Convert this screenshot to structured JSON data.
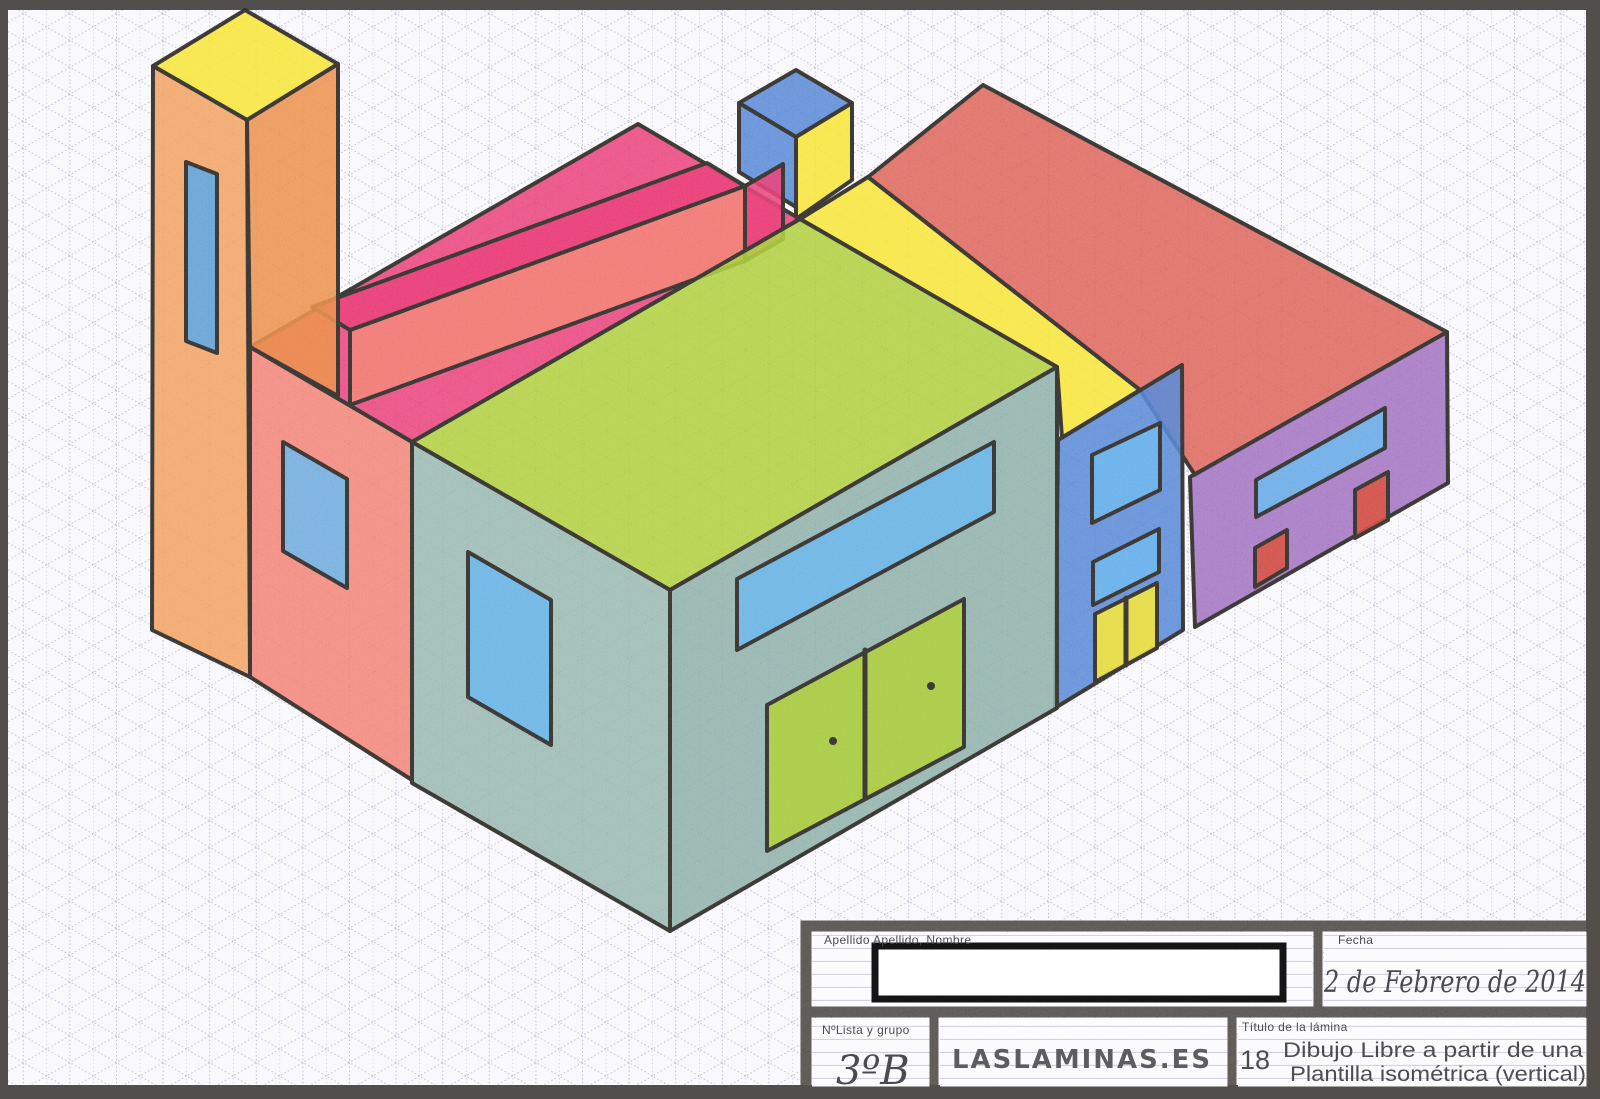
{
  "colors": {
    "frame": "#524e4c",
    "paper": "#f8f7fb",
    "grid": "#a8a4c2",
    "outline": "#2f2c29",
    "orange": "#f09a55",
    "orange_dark": "#e98840",
    "yellow": "#f6e42a",
    "window_blue": "#4f9fe3",
    "sky_blue": "#62b0ea",
    "magenta": "#e7366f",
    "salmon": "#f17a6c",
    "green": "#a7cb30",
    "teal_left": "#90b2a9",
    "teal_right": "#84aaa2",
    "blue": "#4b7fd3",
    "red_roof": "#d95a4e",
    "purple": "#9a68bb",
    "red_accent": "#d64534",
    "white": "#ffffff",
    "box_border": "#0d0d0d",
    "label": "#3a3a3a",
    "text": "#3d3d3d",
    "hand_ink": "#3a3a42",
    "logo_ink": "#4e4e4e"
  },
  "artwork": {
    "description": "Hand-drawn isometric building complex in colored pencil on vertical isometric grid paper",
    "parts": [
      "orange tower with yellow cap and blue slot window",
      "pink roof block with raised pink parapet bar",
      "salmon wall with blue window",
      "teal building with lime green roof, blue windows and green double doors",
      "blue rooftop cube on yellow column",
      "yellow connecting strip",
      "red roofed wing",
      "blue facade with two sky windows and yellow double door",
      "purple facade with sky window, red door and red window"
    ]
  },
  "title_block": {
    "name_label": "Apellido Apellido, Nombre",
    "fecha_label": "Fecha",
    "fecha_value": "2 de Febrero de 2014",
    "lista_label": "NºLista y grupo",
    "lista_value": "3ºB",
    "logo": "LASLAMINAS.ES",
    "titulo_label": "Título de la lámina",
    "numero": "18",
    "titulo_line1": "Dibujo Libre a partir de una",
    "titulo_line2": "Plantilla isométrica (vertical)"
  }
}
